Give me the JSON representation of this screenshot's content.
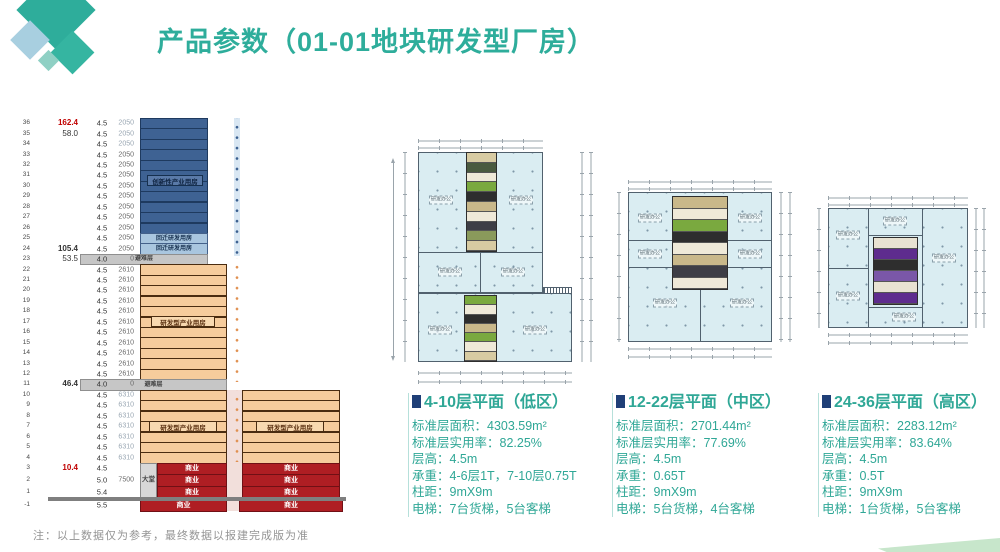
{
  "header": {
    "title": "产品参数（01-01地块研发型厂房）"
  },
  "colors": {
    "teal": "#2EAD9B",
    "caption_teal": "#2FA796",
    "navy": "#1F3F77",
    "tower_blue": "#3E6293",
    "tower_blue_border": "#1E3A5F",
    "tower_lblue": "#A9C6DF",
    "tower_lblue_border": "#44618A",
    "gray": "#C6C6C6",
    "gray_border": "#8F8F8F",
    "orange": "#F6CC9C",
    "orange_border": "#4A2C10",
    "red": "#AF1E23",
    "red_border": "#701015",
    "lobby": "#D8D8D8",
    "ground": "#7F7F7F",
    "plan_fill": "#DAEDF2",
    "purple": "#5E2C8E",
    "green": "#7AA93F",
    "dot_blue": "#3A5F8F",
    "dot_orange": "#E09050",
    "strip_blue": "#D9E7F3",
    "gap_pink": "#F2DFDB"
  },
  "section": {
    "labels": {
      "innovation": "创新性产业用房",
      "relocation": "回迁研发用房",
      "refuge": "避难层",
      "rnd": "研发型产业用房",
      "retail": "商业",
      "lobby": "大堂"
    },
    "note": "注：以上数据仅为参考，最终数据以报建完成版为准",
    "floors": [
      {
        "n": "36",
        "h": "162.4",
        "hs": "red",
        "fh": "4.5",
        "a": "2050",
        "as": "light",
        "z": "blue"
      },
      {
        "n": "35",
        "h": "58.0",
        "fh": "4.5",
        "a": "2050",
        "as": "light",
        "z": "blue"
      },
      {
        "n": "34",
        "fh": "4.5",
        "a": "2050",
        "as": "light",
        "z": "blue"
      },
      {
        "n": "33",
        "fh": "4.5",
        "a": "2050",
        "z": "blue"
      },
      {
        "n": "32",
        "fh": "4.5",
        "a": "2050",
        "z": "blue"
      },
      {
        "n": "31",
        "fh": "4.5",
        "a": "2050",
        "z": "blue"
      },
      {
        "n": "30",
        "fh": "4.5",
        "a": "2050",
        "z": "blue"
      },
      {
        "n": "29",
        "fh": "4.5",
        "a": "2050",
        "z": "blue"
      },
      {
        "n": "28",
        "fh": "4.5",
        "a": "2050",
        "z": "blue"
      },
      {
        "n": "27",
        "fh": "4.5",
        "a": "2050",
        "z": "blue"
      },
      {
        "n": "26",
        "fh": "4.5",
        "a": "2050",
        "z": "blue"
      },
      {
        "n": "25",
        "fh": "4.5",
        "a": "2050",
        "z": "lblue"
      },
      {
        "n": "24",
        "h": "105.4",
        "hs": "bold",
        "fh": "4.5",
        "a": "2050",
        "z": "lblue"
      },
      {
        "n": "23",
        "h": "53.5",
        "fh": "4.0",
        "a": "0",
        "z": "refA"
      },
      {
        "n": "22",
        "fh": "4.5",
        "a": "2610",
        "z": "orange"
      },
      {
        "n": "21",
        "fh": "4.5",
        "a": "2610",
        "z": "orange"
      },
      {
        "n": "20",
        "fh": "4.5",
        "a": "2610",
        "z": "orange"
      },
      {
        "n": "19",
        "fh": "4.5",
        "a": "2610",
        "z": "orange"
      },
      {
        "n": "18",
        "fh": "4.5",
        "a": "2610",
        "z": "orange"
      },
      {
        "n": "17",
        "fh": "4.5",
        "a": "2610",
        "z": "orange"
      },
      {
        "n": "16",
        "fh": "4.5",
        "a": "2610",
        "z": "orange"
      },
      {
        "n": "15",
        "fh": "4.5",
        "a": "2610",
        "z": "orange"
      },
      {
        "n": "14",
        "fh": "4.5",
        "a": "2610",
        "z": "orange"
      },
      {
        "n": "13",
        "fh": "4.5",
        "a": "2610",
        "z": "orange"
      },
      {
        "n": "12",
        "fh": "4.5",
        "a": "2610",
        "z": "orange"
      },
      {
        "n": "11",
        "h": "46.4",
        "hs": "bold",
        "fh": "4.0",
        "a": "0",
        "z": "refB"
      },
      {
        "n": "10",
        "fh": "4.5",
        "a": "6310",
        "as": "light",
        "z": "orange2"
      },
      {
        "n": "9",
        "fh": "4.5",
        "a": "6310",
        "as": "light",
        "z": "orange2"
      },
      {
        "n": "8",
        "fh": "4.5",
        "a": "6310",
        "as": "light",
        "z": "orange2"
      },
      {
        "n": "7",
        "fh": "4.5",
        "a": "6310",
        "as": "light",
        "z": "orange2"
      },
      {
        "n": "6",
        "fh": "4.5",
        "a": "6310",
        "as": "light",
        "z": "orange2"
      },
      {
        "n": "5",
        "fh": "4.5",
        "a": "6310",
        "as": "light",
        "z": "orange2"
      },
      {
        "n": "4",
        "fh": "4.5",
        "a": "6310",
        "as": "light",
        "z": "orange2"
      },
      {
        "n": "3",
        "h": "10.4",
        "hs": "red",
        "fh": "4.5",
        "z": "retail"
      },
      {
        "n": "2",
        "fh": "5.0",
        "a": "7500",
        "z": "retail"
      },
      {
        "n": "1",
        "fh": "5.4",
        "z": "retail"
      },
      {
        "n": "-1",
        "fh": "5.5",
        "z": "retailB"
      }
    ]
  },
  "plans": [
    {
      "title": "4-10层平面（低区）",
      "room_label": "研发办公",
      "specs": [
        "标准层面积：4303.59m²",
        "标准层实用率：82.25%",
        "层高：4.5m",
        "承重：4-6层1T，7-10层0.75T",
        "柱距：9mX9m",
        "电梯：7台货梯，5台客梯"
      ]
    },
    {
      "title": "12-22层平面（中区）",
      "room_label": "研发办公",
      "specs": [
        "标准层面积：2701.44m²",
        "标准层实用率：77.69%",
        "层高：4.5m",
        "承重：0.65T",
        "柱距：9mX9m",
        "电梯：5台货梯，4台客梯"
      ]
    },
    {
      "title": "24-36层平面（高区）",
      "room_label": "研发办公",
      "specs": [
        "标准层面积：2283.12m²",
        "标准层实用率：83.64%",
        "层高：4.5m",
        "承重：0.5T",
        "柱距：9mX9m",
        "电梯：1台货梯，5台客梯"
      ]
    }
  ]
}
